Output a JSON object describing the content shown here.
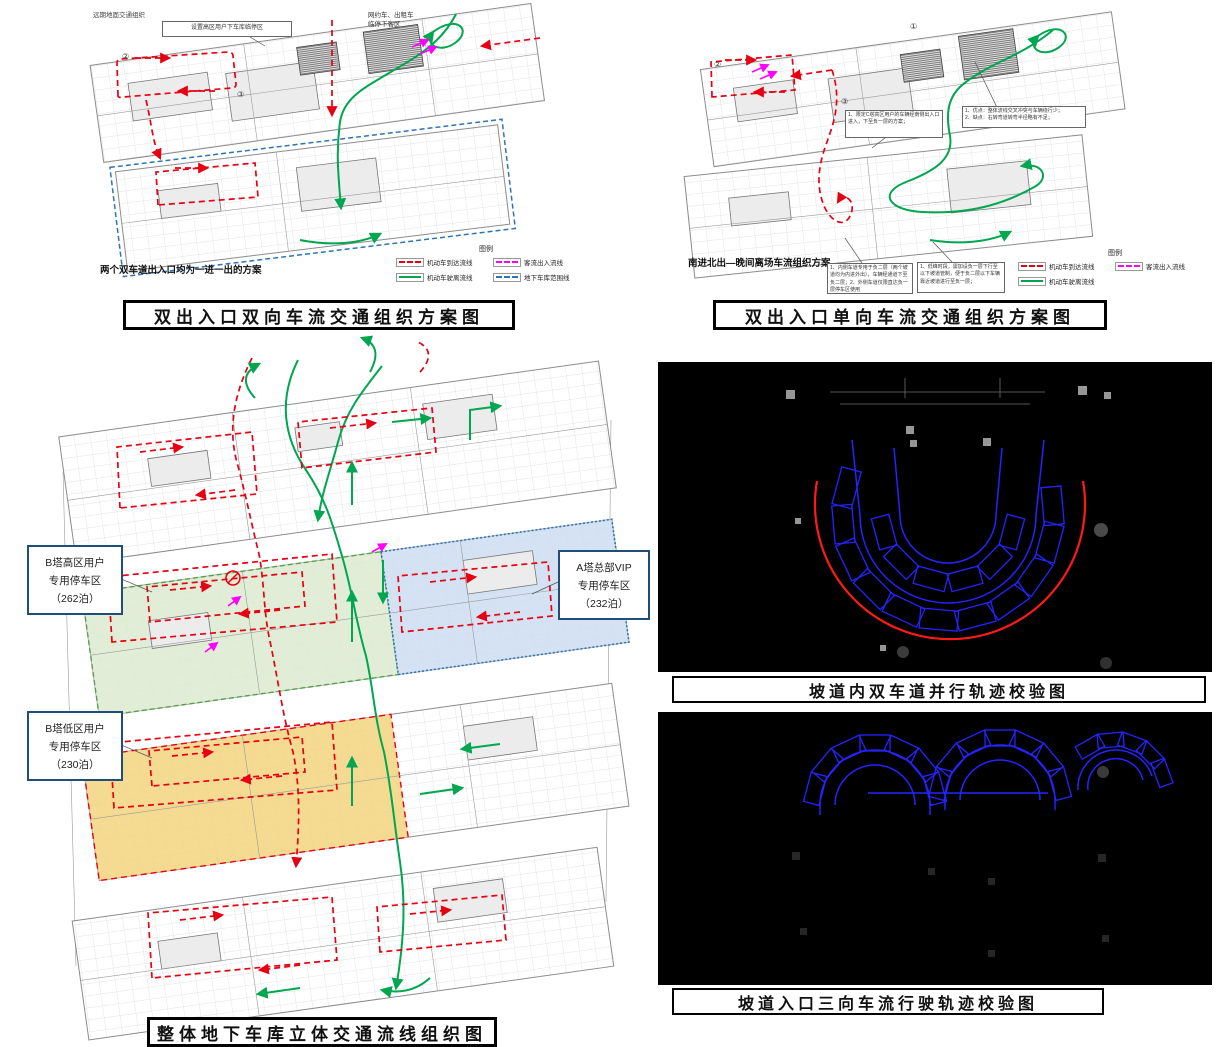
{
  "fig1": {
    "caption": "双出入口双向车流交通组织方案图",
    "corner_note": "远期地面交通组织",
    "callout": "设置高区用户下车库临停区",
    "dropoff_line1": "网约车、出租车",
    "dropoff_line2": "临停下客区",
    "bottom_note": "两个双车道出入口均为一进一出的方案",
    "legend_title": "图例",
    "legend": [
      {
        "label": "机动车到达流线"
      },
      {
        "label": "机动车驶离流线"
      },
      {
        "label": "客流出入流线"
      },
      {
        "label": "地下车库范围线"
      }
    ],
    "markers": {
      "m2": "②",
      "m3": "③"
    }
  },
  "fig2": {
    "caption": "双出入口单向车流交通组织方案图",
    "scheme_label": "南进北出—晚间离场车流组织方案",
    "callout1": "1、限定C塔高区用户的车辆经南侧出入口进入，下至负一层的方案；",
    "callout2_line1": "1、优点：整体流线交叉冲突与车辆绕行少；",
    "callout2_line2": "2、缺点：右转弯道转弯半径略有不足；",
    "note1": "1、内侧车道专用于负二层（两个坡道均为内进外出），车辆经通道下至负二层；2、外侧车道仅限直达负一层停车区使用",
    "note2": "1、低峰时段，需加设负一层下行至以下坡道管制，便于负二层以下车辆靠近坡道进行至负一层；",
    "legend_title": "图例",
    "legend": [
      {
        "label": "机动车到达流线"
      },
      {
        "label": "机动车驶离流线"
      },
      {
        "label": "客流出入流线"
      }
    ],
    "markers": {
      "m1": "①",
      "m2": "②",
      "m3": "③"
    }
  },
  "fig3": {
    "caption": "整体地下车库立体交通流线组织图",
    "zone_b_high": {
      "line1": "B塔高区用户",
      "line2": "专用停车区",
      "line3": "（262泊）"
    },
    "zone_a_vip": {
      "line1": "A塔总部VIP",
      "line2": "专用停车区",
      "line3": "（232泊）"
    },
    "zone_b_low": {
      "line1": "B塔低区用户",
      "line2": "专用停车区",
      "line3": "（230泊）"
    }
  },
  "fig4": {
    "caption": "坡道内双车道并行轨迹校验图"
  },
  "fig5": {
    "caption": "坡道入口三向车流行驶轨迹校验图"
  },
  "colors": {
    "arrival_red": "#e60012",
    "departure_green": "#00a650",
    "passenger_magenta": "#ff00ff",
    "garage_boundary_blue": "#2e75b6",
    "trajectory_blue": "#2424ff",
    "check_red": "#ff1a1a",
    "zone_green_fill": "#dcead0",
    "zone_blue_fill": "#cdddf2",
    "zone_yellow_fill": "#f3d37f",
    "panel_black": "#000000"
  }
}
